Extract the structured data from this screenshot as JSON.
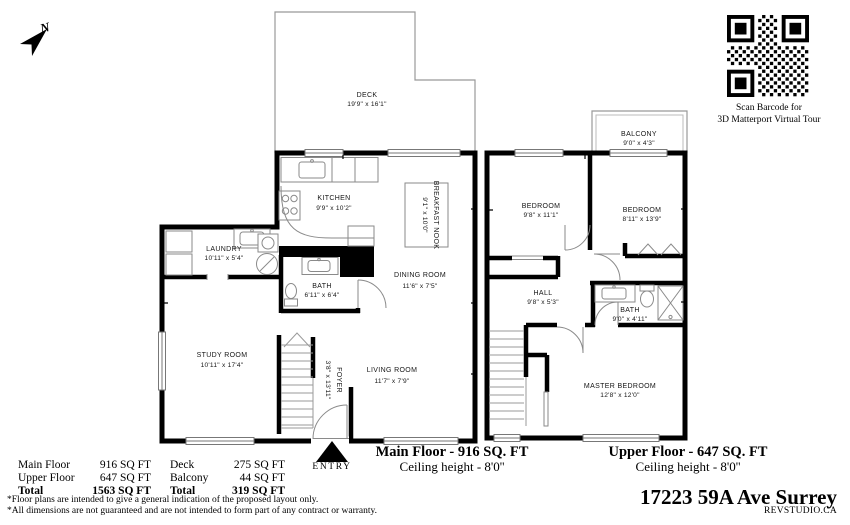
{
  "compass": {
    "label": "N"
  },
  "qr": {
    "caption1": "Scan Barcode for",
    "caption2": "3D Matterport Virtual Tour"
  },
  "floors": {
    "main": {
      "title": "Main Floor - 916 SQ. FT",
      "ceiling": "Ceiling height - 8'0''",
      "rooms": {
        "deck": {
          "name": "DECK",
          "dims": "19'9\" x 16'1\""
        },
        "kitchen": {
          "name": "KITCHEN",
          "dims": "9'9\" x 10'2\""
        },
        "breakfast_nook": {
          "name": "BREAKFAST NOOK",
          "dims": "9'1\" x 10'0\""
        },
        "laundry": {
          "name": "LAUNDRY",
          "dims": "10'11\" x 5'4\""
        },
        "bath": {
          "name": "BATH",
          "dims": "6'11\" x 6'4\""
        },
        "dining": {
          "name": "DINING ROOM",
          "dims": "11'6\" x 7'5\""
        },
        "study": {
          "name": "STUDY ROOM",
          "dims": "10'11\" x 17'4\""
        },
        "foyer": {
          "name": "FOYER",
          "dims": "3'8\" x 13'11\""
        },
        "living": {
          "name": "LIVING ROOM",
          "dims": "11'7\" x 7'9\""
        }
      }
    },
    "upper": {
      "title": "Upper Floor - 647 SQ. FT",
      "ceiling": "Ceiling height - 8'0''",
      "rooms": {
        "balcony": {
          "name": "BALCONY",
          "dims": "9'0\" x 4'3\""
        },
        "bedroom_left": {
          "name": "BEDROOM",
          "dims": "9'8\" x 11'1\""
        },
        "bedroom_right": {
          "name": "BEDROOM",
          "dims": "8'11\" x 13'9\""
        },
        "hall": {
          "name": "HALL",
          "dims": "9'8\" x 5'3\""
        },
        "bath": {
          "name": "BATH",
          "dims": "9'0\" x 4'11\""
        },
        "master": {
          "name": "MASTER BEDROOM",
          "dims": "12'8\" x 12'0\""
        }
      }
    }
  },
  "entry": {
    "label": "ENTRY"
  },
  "area_table": {
    "left": [
      {
        "label": "Main Floor",
        "value": "916 SQ FT"
      },
      {
        "label": "Upper Floor",
        "value": "647 SQ FT"
      },
      {
        "label": "Total",
        "value": "1563 SQ FT"
      }
    ],
    "right": [
      {
        "label": "Deck",
        "value": "275 SQ FT"
      },
      {
        "label": "Balcony",
        "value": "44 SQ FT"
      },
      {
        "label": "Total",
        "value": "319 SQ FT"
      }
    ]
  },
  "disclaimers": [
    "*Floor plans are intended to give a general indication of the proposed layout only.",
    "*All dimensions are not guaranteed and are not intended to form part of any contract or warranty."
  ],
  "address": "17223 59A Ave Surrey",
  "brand": "REVSTUDIO.CA"
}
